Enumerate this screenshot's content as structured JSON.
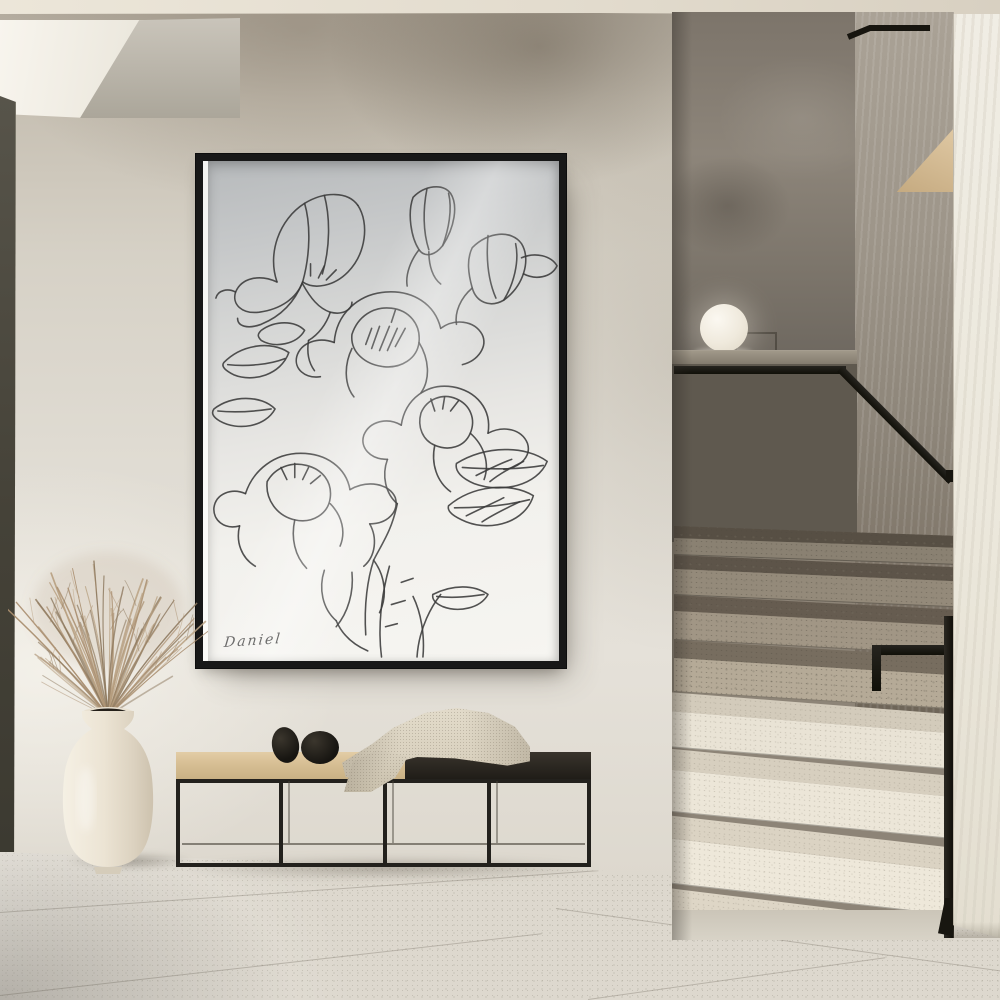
{
  "artwork": {
    "signature": "Daniel",
    "viewbox": "0 0 356 496",
    "svg_paths": [
      "M70,120 C60,92 72,58 98,42 C118,30 142,30 152,44",
      "M152,44 C164,62 160,92 142,110 C128,124 108,128 96,120",
      "M98,42 C104,62 104,92 96,120",
      "M118,34 C124,56 124,86 116,112",
      "M70,120 C52,112 34,116 28,130 C24,142 34,152 52,150 C74,147 90,136 96,120",
      "M28,130 C20,126 10,128 8,136",
      "M96,120 C88,140 74,154 54,162 C40,167 30,164 30,156",
      "M96,122 C104,136 112,146 124,150 C136,153 146,148 146,140",
      "M124,150 C120,162 112,172 102,178",
      "M102,178 C100,190 102,200 108,208",
      "M112,116 l6,-12",
      "M120,118 l10,-10",
      "M104,114 l0,-12",
      "M208,36 C220,24 238,22 246,32 C254,44 250,66 238,84 C230,94 220,96 214,88 C206,76 202,52 208,36",
      "M222,28 C218,48 218,70 224,88",
      "M238,84 C244,68 248,48 244,32",
      "M214,88 C206,98 200,112 202,124",
      "M224,90 C224,104 228,116 236,122",
      "M268,86 C284,70 308,68 318,82 C328,98 320,124 300,138 C286,146 272,140 268,126 C264,112 262,98 268,86",
      "M284,74 C282,96 284,118 292,136",
      "M300,138 C310,122 316,100 312,82",
      "M268,126 C256,136 250,150 252,162",
      "M318,96 C332,90 348,94 354,104 C348,116 332,118 320,112",
      "M128,180 C130,152 152,132 180,130 C208,128 230,142 236,166",
      "M236,166 C250,156 270,158 278,172 C284,184 274,198 258,202",
      "M128,180 C112,174 94,180 90,194 C87,206 98,216 114,214",
      "M146,172 C152,154 168,144 186,146 C204,148 216,162 214,180 C212,196 196,206 178,204 C160,202 144,190 146,172",
      "M214,180 C224,196 226,216 216,230",
      "M146,186 C138,202 138,222 148,234",
      "M166,186 l8,-22",
      "M174,188 l10,-24",
      "M182,188 l10,-22",
      "M190,184 l10,-18",
      "M160,182 l6,-16",
      "M186,160 l4,-12",
      "M196,262 C200,236 222,220 248,224 C272,228 288,246 284,270",
      "M284,270 C300,262 318,266 324,280 C328,292 318,304 300,306",
      "M196,262 C182,254 164,258 158,272 C154,284 164,296 182,296",
      "M216,250 C222,236 238,230 252,236 C266,242 272,256 266,270 C260,284 244,288 230,282 C218,277 212,264 216,250",
      "M230,282 C226,300 232,318 246,328",
      "M266,270 C280,282 286,300 280,316",
      "M182,296 C176,312 180,330 192,340",
      "M238,246 l2,-12",
      "M246,248 l8,-10",
      "M230,248 l-4,-12",
      "M252,300 C282,282 322,282 344,298 C334,322 298,330 270,320 C258,315 250,308 252,300",
      "M258,304 C286,306 316,306 340,302",
      "M272,312 C284,306 296,300 308,296",
      "M286,318 C296,310 308,304 320,298",
      "M244,342 C268,322 306,318 330,332 C322,358 288,368 262,358 C250,353 242,348 244,342",
      "M250,344 C274,344 302,342 326,336",
      "M262,352 C274,346 288,340 300,334",
      "M278,358 C290,350 304,344 316,338",
      "M38,330 C46,306 68,290 94,290 C120,290 140,304 144,326",
      "M144,326 C162,316 184,320 190,334 C194,348 182,360 164,360",
      "M38,330 C24,324 8,330 6,344 C5,356 16,366 32,362",
      "M60,318 C68,304 84,298 100,302 C116,306 126,318 124,334 C122,350 106,360 88,356 C70,352 58,336 60,318",
      "M32,362 C28,378 34,394 48,402",
      "M164,360 C172,374 170,392 158,402",
      "M88,356 C84,374 88,392 100,404",
      "M124,340 C136,352 140,368 134,382",
      "M88,314 l0,-14",
      "M96,316 l6,-12",
      "M80,316 l-6,-12",
      "M104,320 l10,-8",
      "M118,406 C112,424 116,444 130,456",
      "M146,408 C148,428 142,448 130,462",
      "M168,396 C180,412 182,432 174,448",
      "M160,470 C158,440 162,414 168,396",
      "M176,492 C172,462 176,430 184,402",
      "M212,492 C214,462 228,440 236,430",
      "M186,440 l14,-4",
      "M180,462 l12,-3",
      "M196,418 l12,-4",
      "M168,396 C176,380 186,368 192,340",
      "M130,456 C136,470 148,480 162,486",
      "M218,492 C220,470 216,448 208,432",
      "M228,430 C248,420 270,420 284,430 C276,444 254,448 238,442 C231,439 227,435 228,430",
      "M232,432 C250,434 266,432 280,430",
      "M16,200 C34,182 64,178 82,190 C74,212 46,220 26,212 C18,208 13,204 16,200",
      "M20,202 C40,204 62,202 78,196",
      "M6,246 C24,232 54,232 68,246 C58,264 30,268 12,258 C5,254 3,250 6,246",
      "M10,248 C30,250 50,248 64,246",
      "M54,168 C68,158 88,158 98,168 C90,182 68,186 54,178 C50,174 50,172 54,168"
    ]
  },
  "plant": {
    "strands": 64,
    "colors": [
      "#a98e6f",
      "#b9a283",
      "#8e7a60"
    ]
  },
  "palette": {
    "wall-light": "#ddd8ce",
    "wall-shadow": "#a79e90",
    "ceiling": "#e9e3d6",
    "door-dark": "#454238",
    "frame-black": "#181818",
    "art-line": "#3a3a3a",
    "paper-top": "#c0c2c4",
    "paper-bottom": "#f6f5f1",
    "bench-wood": "#d8c096",
    "bench-dark": "#2b2721",
    "pebble-black": "#1b1915",
    "blanket-cream": "#dcd4c2",
    "vase-cream": "#ece4d4",
    "grass-brown": "#a98e6f",
    "sphere-white": "#f3efe6",
    "niche-dark": "#7c746a",
    "parapet-dark": "#5c564d",
    "rail-black": "#17150f",
    "step-shadow": "#948a7a",
    "step-light": "#ece6d8",
    "wood-wedge": "#d3b78e",
    "floor-tile": "#d9d5ca",
    "right-wall": "#eeebe1"
  }
}
